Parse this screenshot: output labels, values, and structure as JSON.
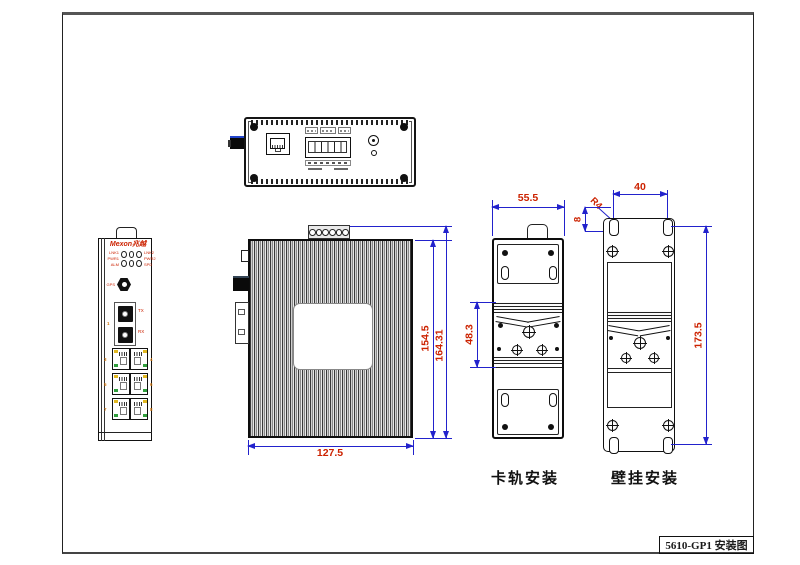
{
  "title_block": {
    "text": "5610-GP1 安装图"
  },
  "front_view": {
    "brand": "Mexon兆越",
    "led_labels_left": [
      "LNK1",
      "PWR1",
      "ALM"
    ],
    "led_labels_right": [
      "LNK2",
      "PWR2",
      "SPD"
    ],
    "antenna_label": "GPS",
    "fiber_labels": {
      "tx": "TX",
      "rx": "RX",
      "port": "1"
    },
    "port_numbers_left": [
      "3",
      "5",
      "7"
    ],
    "port_numbers_right": [
      "4",
      "6",
      "8"
    ]
  },
  "side_view": {
    "dims": {
      "width": "127.5",
      "body_height": "154.5",
      "total_height": "164.31"
    }
  },
  "din_rail_view": {
    "caption": "卡轨安装",
    "dims": {
      "width": "55.5",
      "clip_height": "48.3"
    }
  },
  "wall_mount_view": {
    "caption": "壁挂安装",
    "dims": {
      "hole_spacing": "40",
      "corner_radius": "R4",
      "hole_offset": "8",
      "height": "173.5"
    }
  },
  "colors": {
    "dimension_line": "#2222cc",
    "dimension_text": "#cc2200",
    "outline": "#1a1a1a",
    "brand_red": "#cc1f1f",
    "led_yellow": "#e2b820",
    "led_green": "#2f9e3c",
    "port_number_orange": "#d4760a"
  }
}
